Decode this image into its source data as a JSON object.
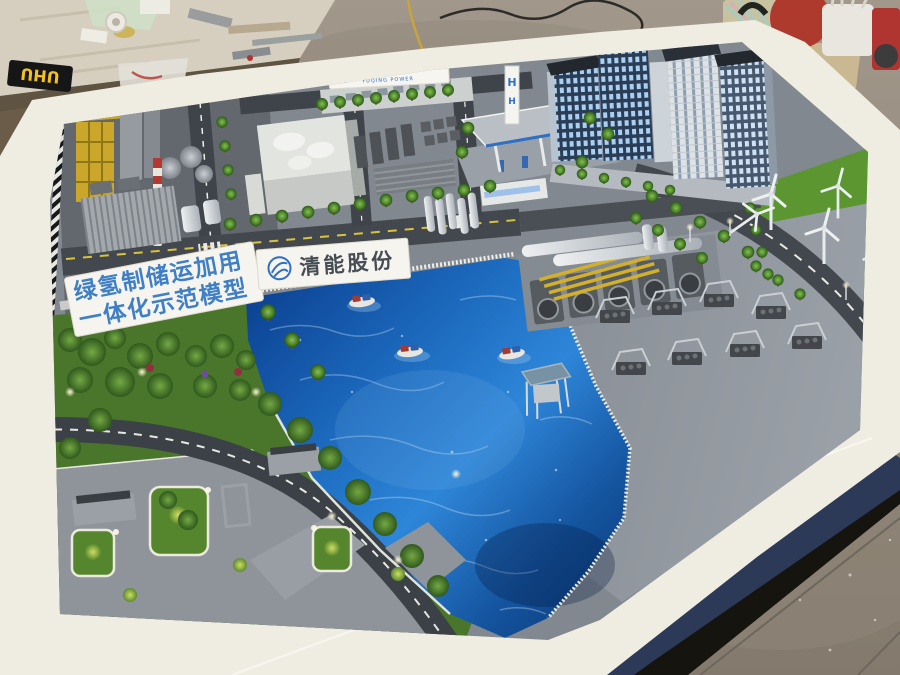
{
  "signs": {
    "banner": {
      "line1": "绿氢制储运加用",
      "line2": "一体化示范模型"
    },
    "company": {
      "name": "清能股份"
    },
    "entrance": {
      "cn": "豫氢动力",
      "en": "YUQING POWER",
      "logo_letter": "H"
    },
    "hydrogen_pillar": {
      "letter_top": "H",
      "letter_bottom": "H"
    },
    "glue_box": {
      "brand": "UHU"
    }
  },
  "colors": {
    "accent_blue": "#2f6fc4",
    "banner_text": "#3f7fc6",
    "water_deep": "#0a3c8c",
    "water_mid": "#2e86d8",
    "water_dark": "#0a346f",
    "lawn_green": "#5b9631",
    "park_green": "#4a762b",
    "table_rim": "#efece1",
    "table_skirt": "#2c3a58",
    "road_asphalt": "#43484e",
    "chimney_red": "#b23a30"
  }
}
